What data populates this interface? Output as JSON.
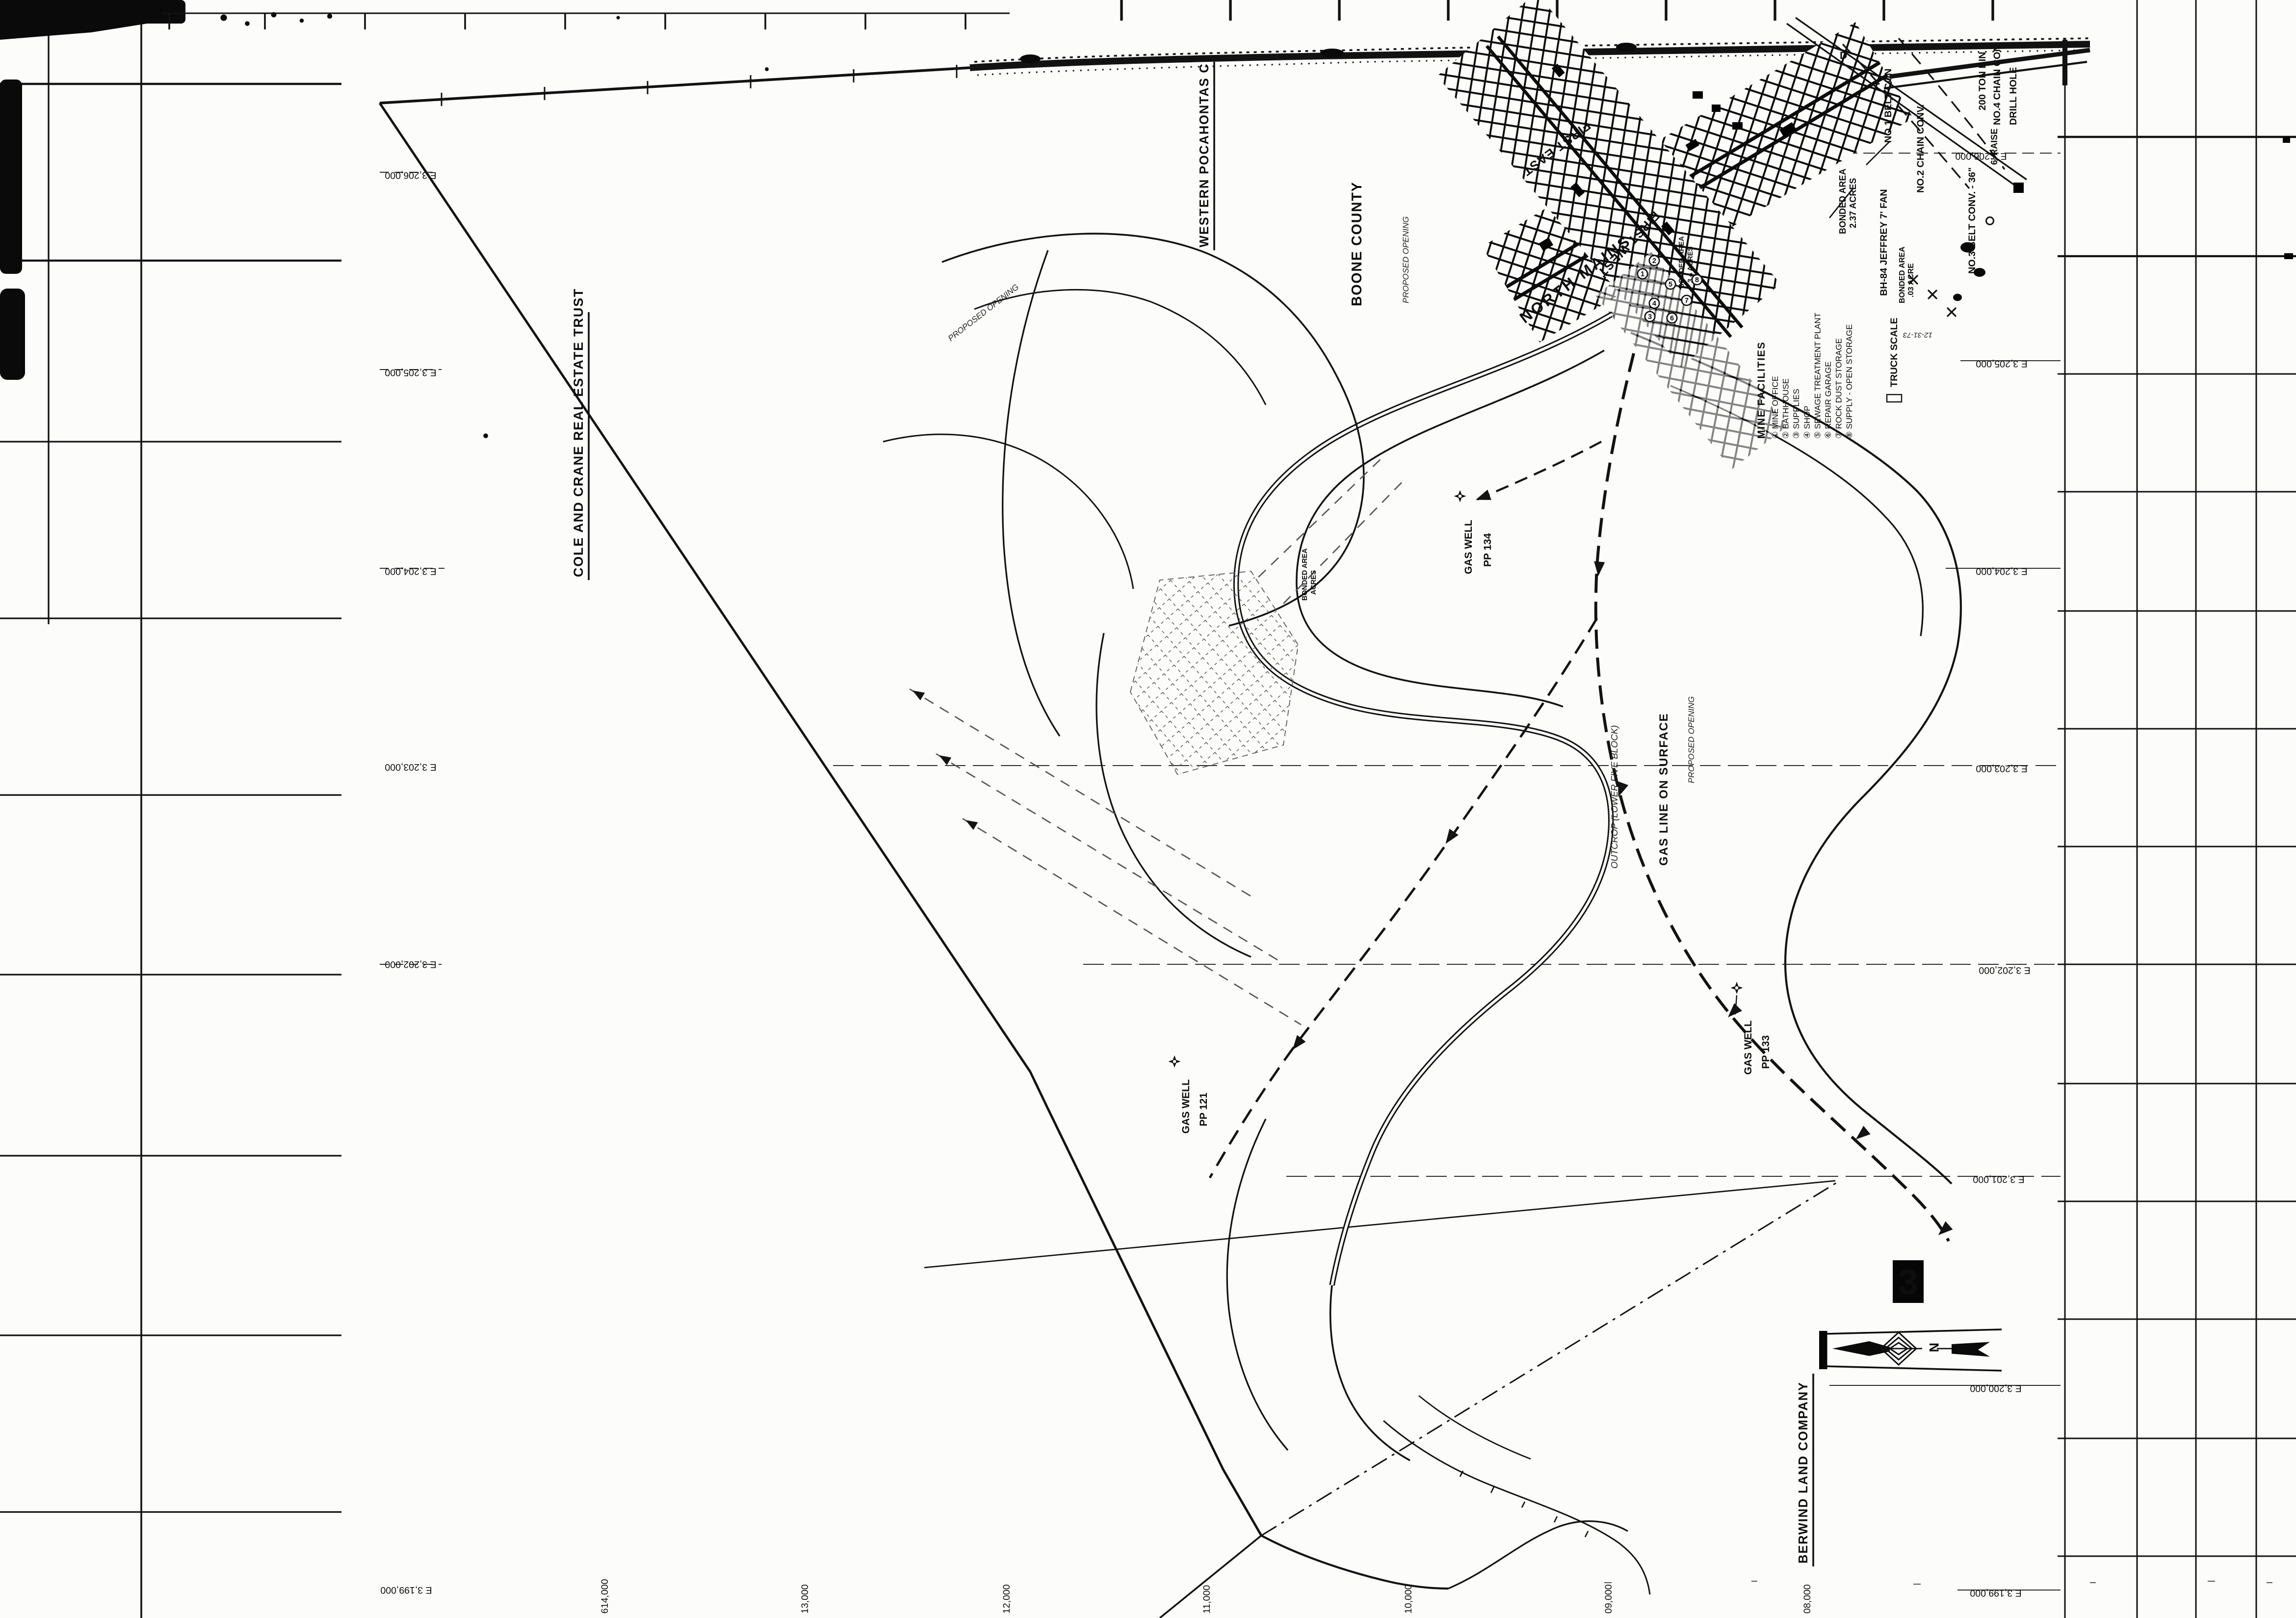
{
  "sheet": {
    "badge": "3",
    "county": "BOONE COUNTY",
    "survey_date": "12-31-73",
    "north_letter": "N",
    "corner_letter": "D"
  },
  "owners": {
    "western_pocahontas": "WESTERN POCAHONTAS C",
    "cole_crane": "COLE AND CRANE REAL ESTATE TRUST",
    "berwind": "BERWIND LAND COMPANY"
  },
  "workings": {
    "north_mains": "NORTH MAINS",
    "first_east": "FIRST EAST",
    "first_west": "FIRST WEST"
  },
  "legend": {
    "title": "MINE FACILITIES",
    "items": [
      "① MINE OFFICE",
      "② BATHHOUSE",
      "③ SUPPLIES",
      "④ SHOP",
      "⑤ SEWAGE TREATMENT PLANT",
      "⑥ REPAIR GARAGE",
      "⑦ ROCK DUST STORAGE",
      "⑧ SUPPLY - OPEN STORAGE"
    ]
  },
  "surface": {
    "belt1": "NO.1 BELT CON",
    "chain2": "NO.2 CHAIN CONV.",
    "belt3": "NO.3 BELT CONV. - 36\"",
    "chain4": "NO.4 CHAIN CON",
    "ton_bin": "200 TON BIN",
    "drill_hole": "DRILL HOLE",
    "raise": "6' RAISE",
    "fan": "BH-84 JEFFREY 7' FAN",
    "truck_scale": "TRUCK SCALE"
  },
  "bonded": {
    "a1": "BONDED AREA",
    "a1_acres": "2.37 ACRES",
    "a2": "BONDED AREA",
    "a2_acres": "3.4 ACRES",
    "a3": "BONDED AREA",
    "a3_acres": ".03 ACRE",
    "a4": "BONDED AREA",
    "a4_acres": "ACRES"
  },
  "gas": {
    "line": "GAS LINE ON SURFACE",
    "well_word": "GAS WELL",
    "wells": [
      "PP 134",
      "PP 133",
      "PP 121"
    ]
  },
  "notes": {
    "outcrop": "OUTCROP (LOWER FIVE BLOCK)",
    "proposed": "PROPOSED OPENING"
  },
  "grid": {
    "east": [
      "E 3,206,000",
      "E 3,205,000",
      "E 3,204,000",
      "E 3,203,000",
      "E 3,202,000",
      "E 3,201,000",
      "E 3,200,000",
      "E 3,199,000"
    ],
    "north": [
      "614,000",
      "13,000",
      "12,000",
      "11,000",
      "10,000",
      "09,000",
      "08,000"
    ]
  },
  "facility_markers": [
    "1",
    "2",
    "3",
    "4",
    "5",
    "6",
    "7",
    "8"
  ]
}
